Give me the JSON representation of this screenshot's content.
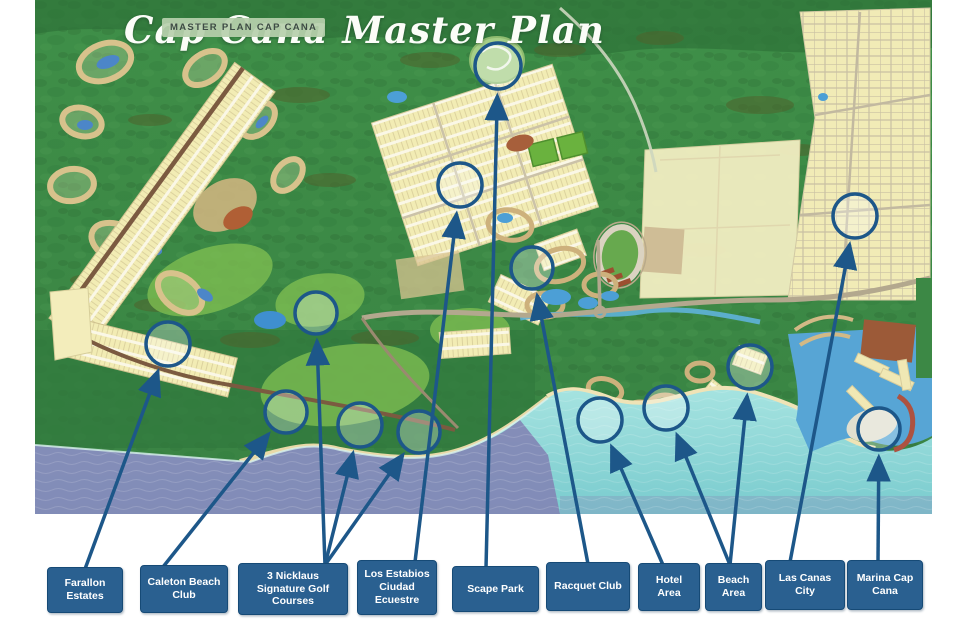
{
  "header": {
    "badge_text": "MASTER PLAN CAP CANA",
    "script_text": "Cap Cana Master Plan"
  },
  "style": {
    "label_bg": "#2a6090",
    "label_border": "#164a76",
    "label_text": "#ffffff",
    "connector": "#1d5789",
    "circle_fill": "rgba(252,254,255,0.30)",
    "badge_bg": "rgba(183,208,172,0.93)",
    "badge_text_color": "#3d4b44",
    "script_color": "#fbfdf8",
    "sea_deep": "#8287b5",
    "sea_shallow": "#8ed7d8",
    "land_green": "#41924a",
    "parcel_yellow": "#f2ecb4"
  },
  "locations": [
    {
      "id": "farallon-estates",
      "label": "Farallon Estates",
      "box": {
        "x": 47,
        "y": 567,
        "w": 76,
        "h": 46
      },
      "anchor_x": 85,
      "targets": [
        {
          "cx": 168,
          "cy": 344,
          "r": 22
        }
      ]
    },
    {
      "id": "caleton-beach-club",
      "label": "Caleton Beach Club",
      "box": {
        "x": 140,
        "y": 565,
        "w": 88,
        "h": 48
      },
      "anchor_x": 163,
      "targets": [
        {
          "cx": 286,
          "cy": 412,
          "r": 21
        }
      ]
    },
    {
      "id": "nicklaus-golf-courses",
      "label": "3 Nicklaus Signature Golf Courses",
      "box": {
        "x": 238,
        "y": 563,
        "w": 110,
        "h": 52
      },
      "anchor_x": 325,
      "targets": [
        {
          "cx": 316,
          "cy": 313,
          "r": 21
        },
        {
          "cx": 360,
          "cy": 425,
          "r": 22
        },
        {
          "cx": 419,
          "cy": 432,
          "r": 21
        }
      ]
    },
    {
      "id": "los-estabios",
      "label": "Los Estabios Ciudad Ecuestre",
      "box": {
        "x": 357,
        "y": 560,
        "w": 80,
        "h": 55
      },
      "anchor_x": 415,
      "targets": [
        {
          "cx": 460,
          "cy": 185,
          "r": 22
        }
      ]
    },
    {
      "id": "scape-park",
      "label": "Scape Park",
      "box": {
        "x": 452,
        "y": 566,
        "w": 87,
        "h": 46
      },
      "anchor_x": 486,
      "targets": [
        {
          "cx": 498,
          "cy": 66,
          "r": 23
        }
      ]
    },
    {
      "id": "racquet-club",
      "label": "Racquet Club",
      "box": {
        "x": 546,
        "y": 562,
        "w": 84,
        "h": 49
      },
      "anchor_x": 588,
      "targets": [
        {
          "cx": 532,
          "cy": 268,
          "r": 21
        }
      ]
    },
    {
      "id": "hotel-area",
      "label": "Hotel Area",
      "box": {
        "x": 638,
        "y": 563,
        "w": 62,
        "h": 48
      },
      "anchor_x": 663,
      "targets": [
        {
          "cx": 600,
          "cy": 420,
          "r": 22
        }
      ]
    },
    {
      "id": "beach-area",
      "label": "Beach Area",
      "box": {
        "x": 705,
        "y": 563,
        "w": 57,
        "h": 48
      },
      "anchor_x": 730,
      "targets": [
        {
          "cx": 666,
          "cy": 408,
          "r": 22
        },
        {
          "cx": 750,
          "cy": 367,
          "r": 22
        }
      ]
    },
    {
      "id": "las-canas-city",
      "label": "Las Canas City",
      "box": {
        "x": 765,
        "y": 560,
        "w": 80,
        "h": 50
      },
      "anchor_x": 790,
      "targets": [
        {
          "cx": 855,
          "cy": 216,
          "r": 22
        }
      ]
    },
    {
      "id": "marina-cap-cana",
      "label": "Marina Cap Cana",
      "box": {
        "x": 847,
        "y": 560,
        "w": 76,
        "h": 50
      },
      "anchor_x": 878,
      "targets": [
        {
          "cx": 879,
          "cy": 429,
          "r": 21
        }
      ]
    }
  ]
}
